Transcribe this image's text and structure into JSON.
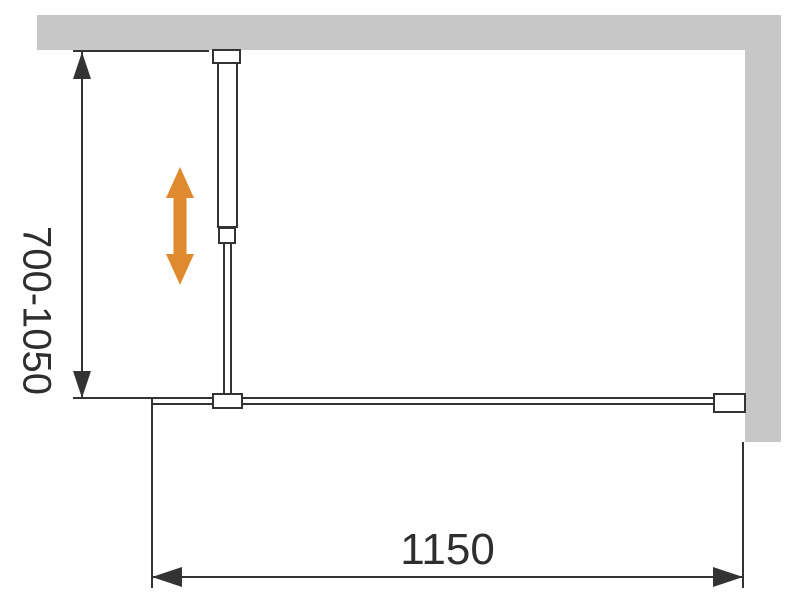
{
  "dimensions": {
    "height_range_label": "700-1050",
    "width_label": "1150"
  },
  "colors": {
    "background": "#ffffff",
    "wall": "#c7c7c7",
    "line": "#333333",
    "text": "#2e2e2e",
    "accent": "#e08a2f"
  },
  "icons": {
    "adjustability_arrow_glyph": "↕",
    "dimension_arrowhead_glyph": "▲"
  }
}
